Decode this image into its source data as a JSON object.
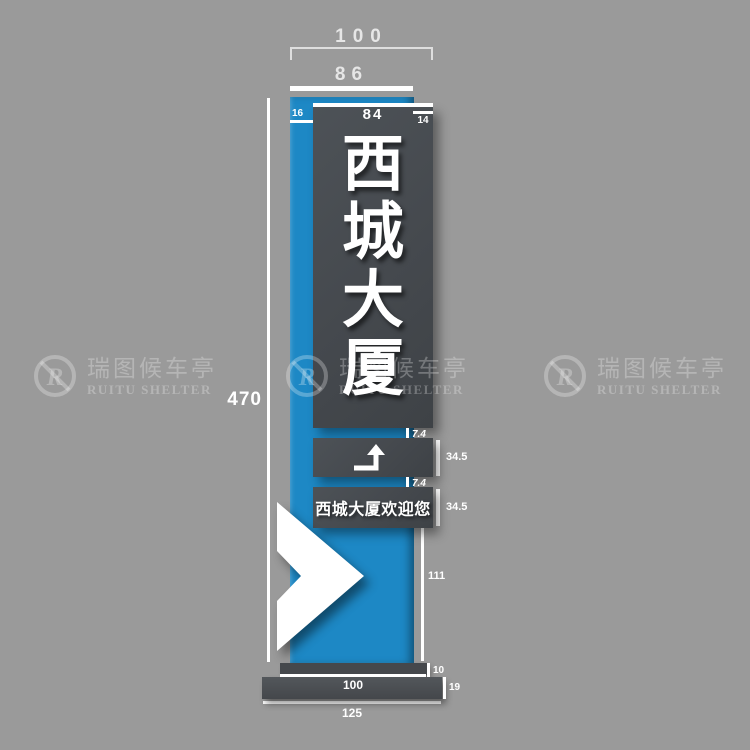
{
  "colors": {
    "background": "#9a9a9a",
    "pillar_blue": "#1d88c5",
    "panel_gray": "#45494e",
    "dimension_white": "#ffffff"
  },
  "signs": {
    "main": {
      "text": "西城大厦",
      "chars": [
        "西",
        "城",
        "大",
        "厦"
      ]
    },
    "direction": {
      "icon": "turn-up-arrow"
    },
    "welcome": {
      "text": "西城大厦欢迎您"
    }
  },
  "dims": {
    "top_width": "100",
    "face_width": "86",
    "panel_width": "84",
    "left_inset": "16",
    "right_inset": "14",
    "total_height": "470",
    "gap_top": "7.4",
    "arrow_panel_height": "34.5",
    "gap_bottom": "7.4",
    "welcome_panel_height": "34.5",
    "lower_column_height": "111",
    "foot_plate_height": "10",
    "foot_plate_width": "100",
    "base_height": "19",
    "base_width": "125"
  },
  "watermark": {
    "logo_letter": "R",
    "title": "瑞图候车亭",
    "subtitle": "RUITU SHELTER"
  }
}
